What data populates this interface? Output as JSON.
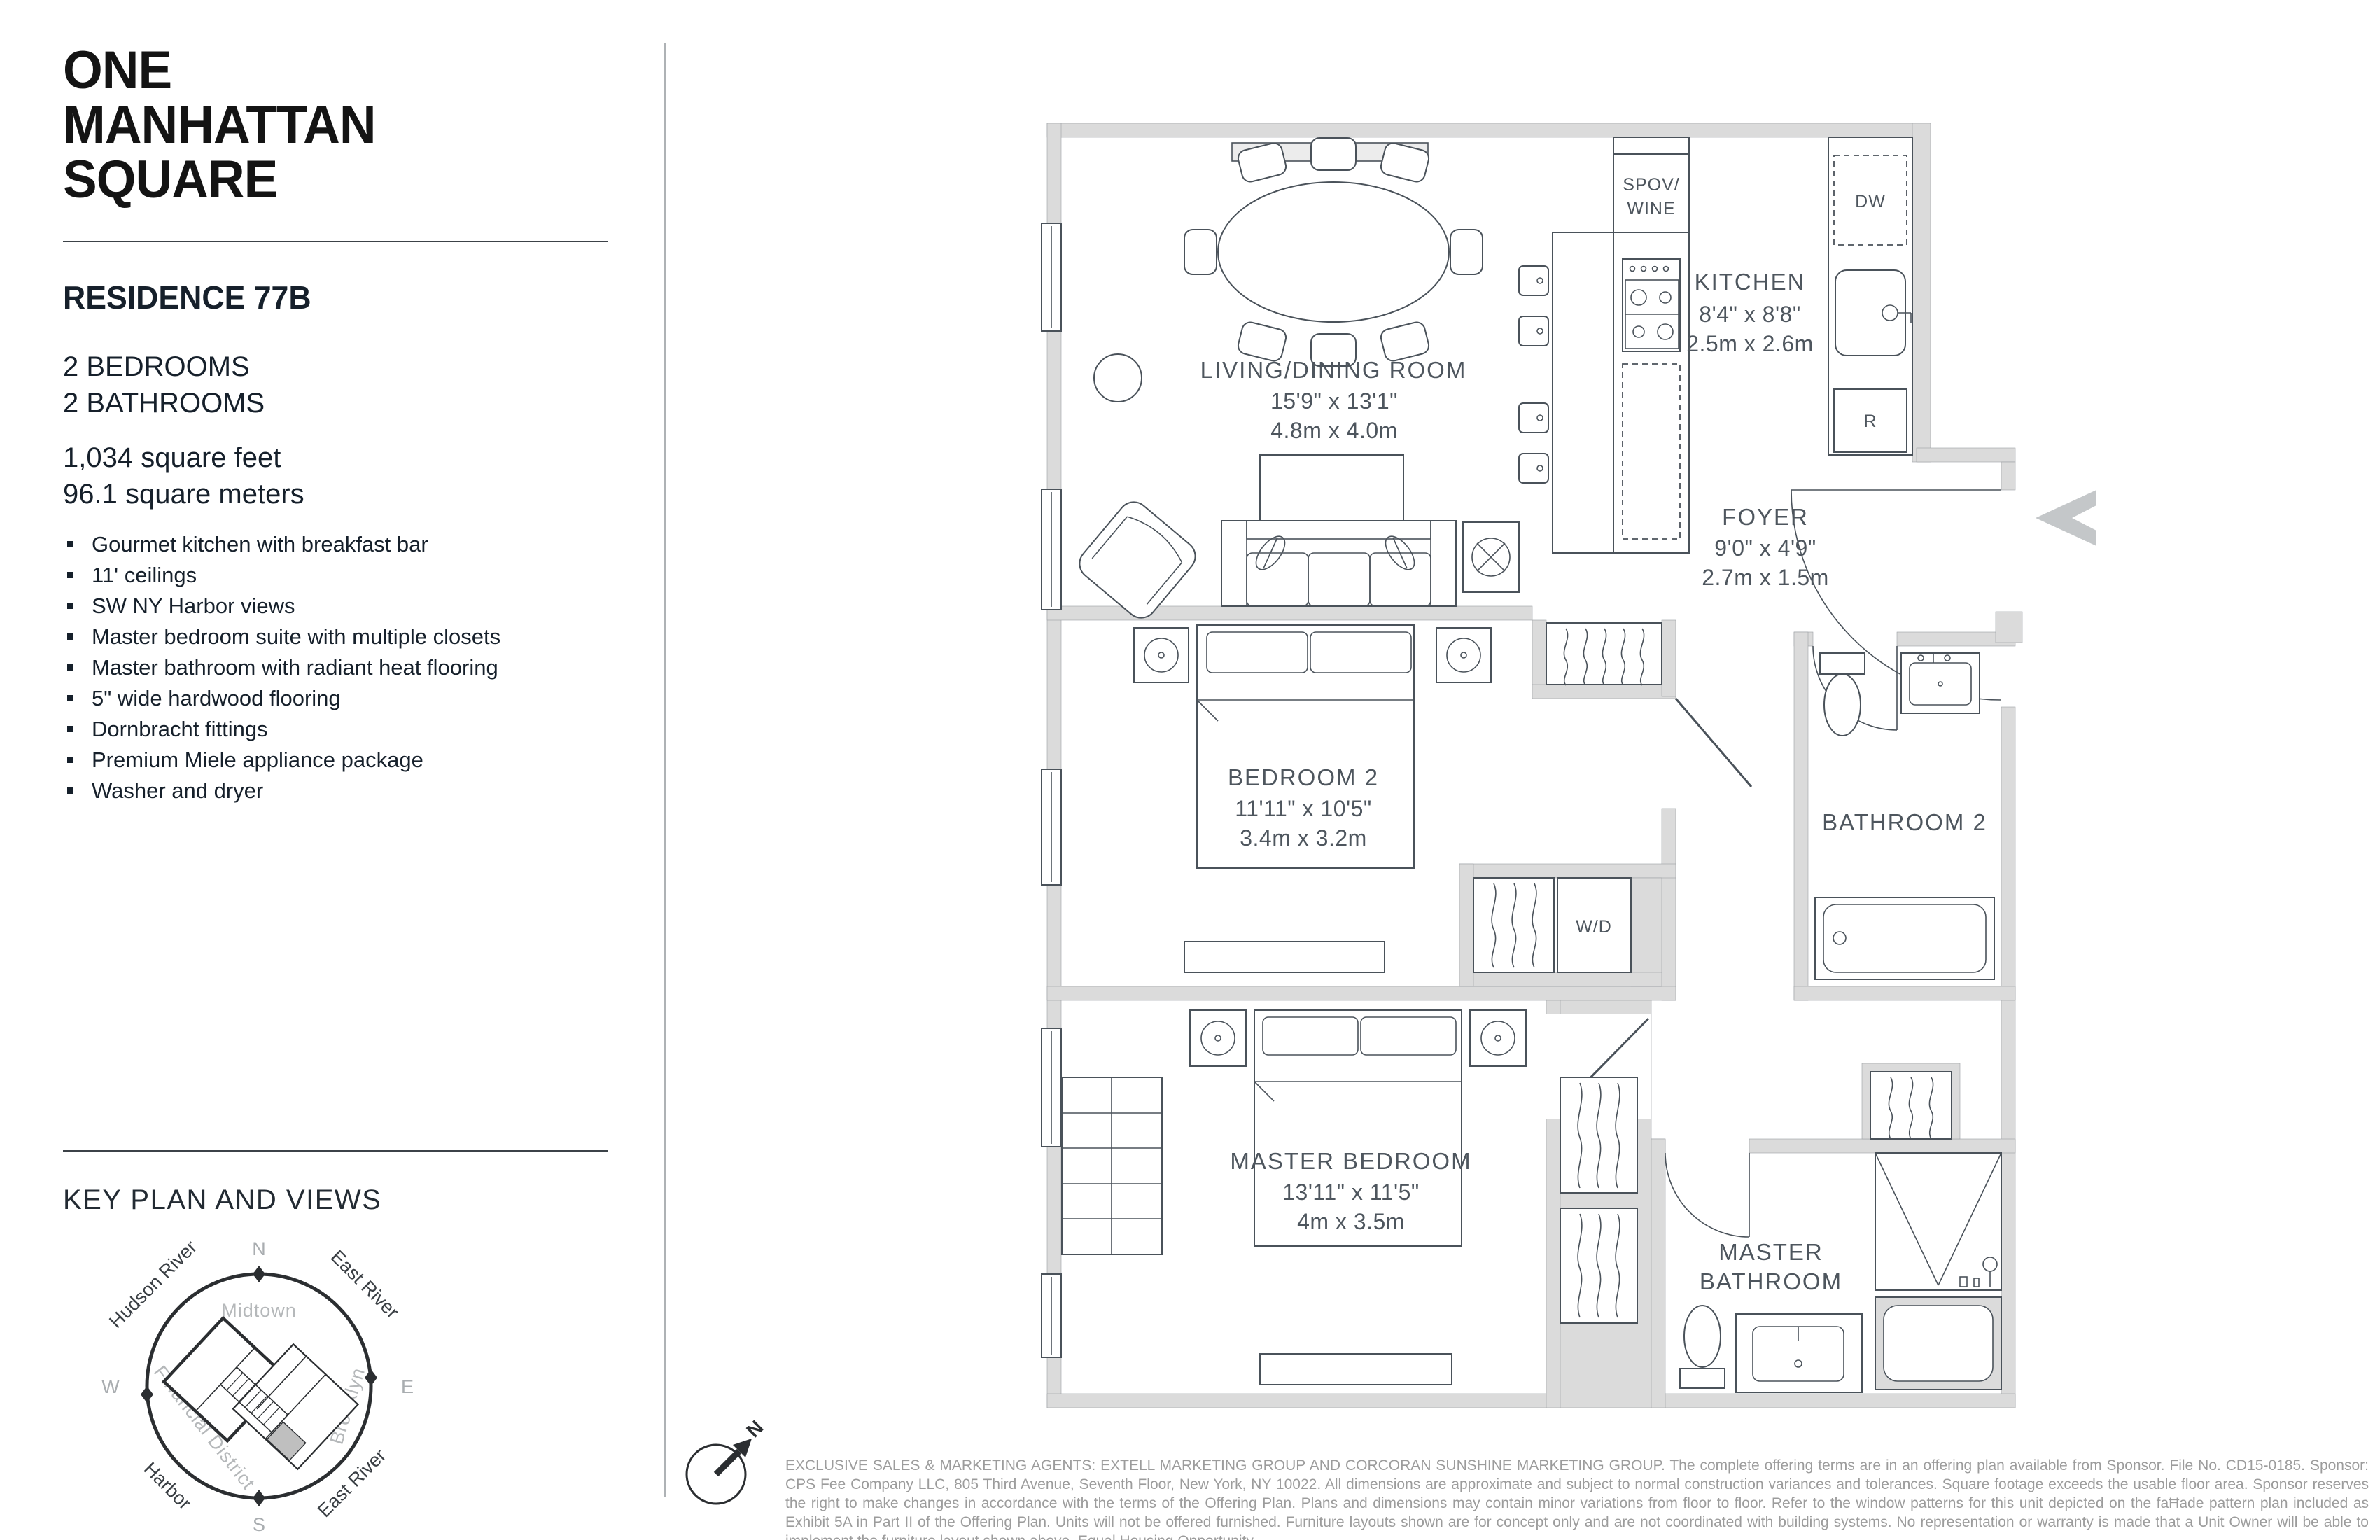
{
  "brand": {
    "line1": "ONE",
    "line2": "MANHATTAN",
    "line3": "SQUARE"
  },
  "residence": {
    "title": "RESIDENCE 77B",
    "line_bedrooms": "2 BEDROOMS",
    "line_bathrooms": "2 BATHROOMS",
    "area_feet": "1,034 square feet",
    "area_meters": "96.1 square meters"
  },
  "features": [
    "Gourmet kitchen with breakfast bar",
    "11' ceilings",
    "SW NY Harbor views",
    "Master bedroom suite with multiple closets",
    "Master bathroom with radiant heat flooring",
    "5\" wide hardwood flooring",
    "Dornbracht fittings",
    "Premium Miele appliance package",
    "Washer and dryer"
  ],
  "key_plan": {
    "title": "KEY PLAN AND VIEWS",
    "compass": {
      "n": "N",
      "e": "E",
      "s": "S",
      "w": "W"
    },
    "ring_labels": {
      "hudson_river": "Hudson River",
      "east_river_top": "East River",
      "midtown": "Midtown",
      "brooklyn": "Brooklyn",
      "financial_district": "Financial District",
      "harbor": "Harbor",
      "east_river_bottom": "East River"
    }
  },
  "floorplan": {
    "north_letter": "N",
    "living": {
      "name": "LIVING/DINING ROOM",
      "imperial": "15'9\" x 13'1\"",
      "metric": "4.8m x 4.0m"
    },
    "kitchen": {
      "name": "KITCHEN",
      "imperial": "8'4\" x 8'8\"",
      "metric": "2.5m x 2.6m"
    },
    "foyer": {
      "name": "FOYER",
      "imperial": "9'0\" x 4'9\"",
      "metric": "2.7m x 1.5m"
    },
    "bedroom2": {
      "name": "BEDROOM 2",
      "imperial": "11'11\" x 10'5\"",
      "metric": "3.4m x 3.2m"
    },
    "bathroom2": {
      "name": "BATHROOM 2"
    },
    "master_bedroom": {
      "name": "MASTER BEDROOM",
      "imperial": "13'11\" x 11'5\"",
      "metric": "4m x 3.5m"
    },
    "master_bathroom": {
      "line1": "MASTER",
      "line2": "BATHROOM"
    },
    "fixtures": {
      "spov_wine_line1": "SPOV/",
      "spov_wine_line2": "WINE",
      "dishwasher": "DW",
      "refrigerator": "R",
      "washer_dryer": "W/D"
    }
  },
  "disclaimer": "EXCLUSIVE SALES & MARKETING AGENTS: EXTELL MARKETING GROUP AND CORCORAN SUNSHINE MARKETING GROUP. The complete offering terms are in an offering plan available from Sponsor. File No. CD15-0185. Sponsor: CPS Fee Company LLC, 805 Third Avenue, Seventh Floor, New York, NY 10022.  All dimensions are approximate and subject to normal construction variances and tolerances. Square footage exceeds the usable floor area. Sponsor reserves the right to make changes in accordance with the terms of the Offering Plan. Plans and dimensions may contain minor variations from floor to floor. Refer to the window patterns for this unit depicted on the faĦade pattern plan included as Exhibit 5A in Part II of the Offering Plan. Units will not be offered furnished. Furniture layouts shown are for concept only and are not coordinated with building systems.  No representation or warranty is made that a Unit Owner will be able to implement the furniture layout shown above. Equal Housing Opportunity."
}
